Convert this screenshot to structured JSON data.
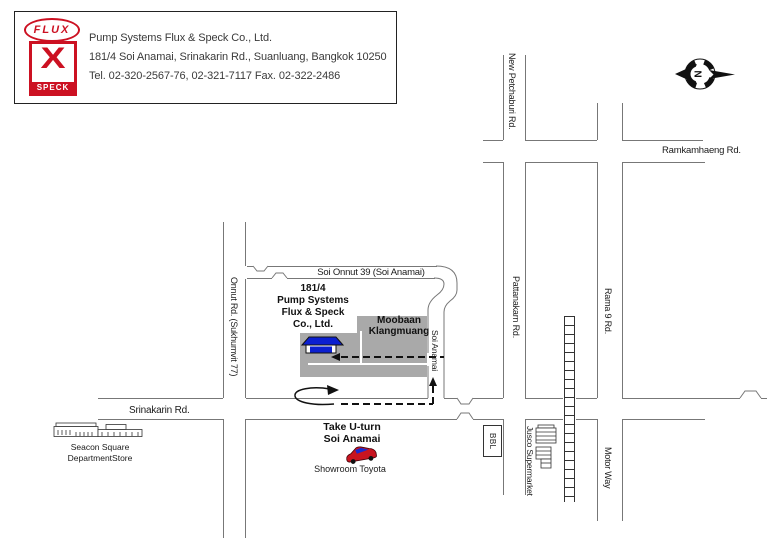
{
  "header": {
    "flux_logo": "FLUX",
    "speck_logo_x": "X",
    "speck_logo_name": "SPECK",
    "company": "Pump Systems Flux & Speck Co., Ltd.",
    "address": "181/4  Soi Anamai, Srinakarin Rd., Suanluang, Bangkok 10250",
    "phone_fax": "Tel. 02-320-2567-76, 02-321-7117  Fax. 02-322-2486"
  },
  "compass": {
    "north": "N"
  },
  "roads": {
    "new_petchaburi": "New Petchaburi Rd.",
    "ramkamhaeng": "Ramkamhaeng Rd.",
    "pattanakarn": "Pattanakarn Rd.",
    "rama9": "Rama 9 Rd.",
    "motor_way": "Motor Way",
    "onnut": "Onnut Rd. (Sukhumvit 77)",
    "soi_onnut39": "Soi Onnut 39 (Soi Anamai)",
    "soi_anamai": "Soi Anamai",
    "srinakarin": "Srinakarin Rd."
  },
  "places": {
    "company_block": {
      "line1": "181/4",
      "line2": "Pump Systems",
      "line3": "Flux & Speck",
      "line4": "Co., Ltd."
    },
    "moobaan": {
      "line1": "Moobaan",
      "line2": "Klangmuang"
    },
    "uturn": {
      "line1": "Take U-turn",
      "line2": "Soi Anamai"
    },
    "showroom": "Showroom Toyota",
    "seacon": {
      "line1": "Seacon Square",
      "line2": "DepartmentStore"
    },
    "bbl": "BBL",
    "jusco": "Jusco Supermarket"
  },
  "colors": {
    "logo_red": "#cc1122",
    "estate_gray": "#a9a9a9",
    "building_blue": "#0b1fd0",
    "car_red": "#c81420",
    "route_black": "#111111",
    "road_line_gray": "#777777"
  }
}
